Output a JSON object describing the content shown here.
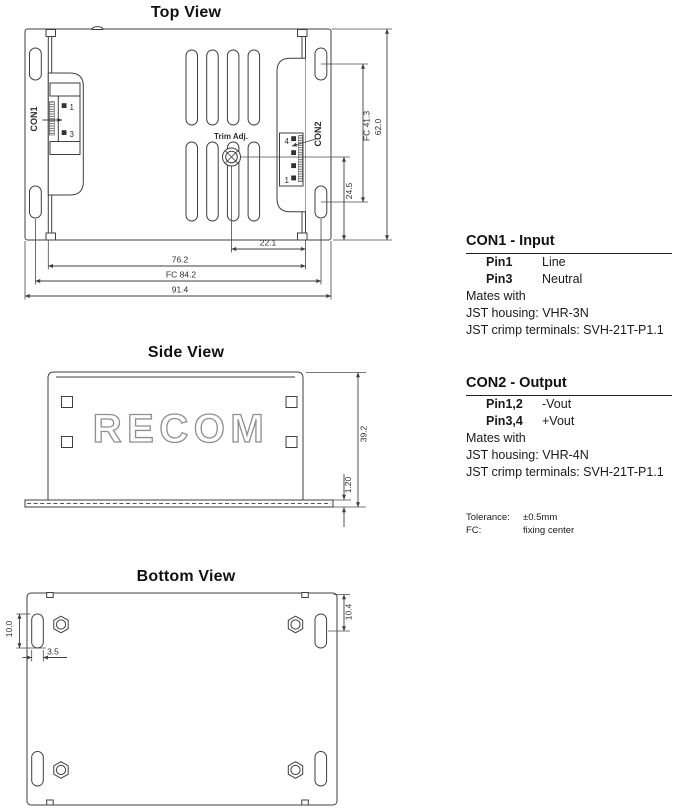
{
  "colors": {
    "line": "#3f3f3f",
    "dim_text": "#2e2e2e",
    "logo_outline": "#8f8f8f",
    "note_text": "#1a1a1a"
  },
  "views": {
    "top": {
      "title": "Top View",
      "con1_label": "CON1",
      "con2_label": "CON2",
      "trim_label": "Trim Adj.",
      "con1_pins": [
        "1",
        "3"
      ],
      "con2_pins": [
        "4",
        "1"
      ],
      "dims": {
        "trim_to_edge": "22.1",
        "body_width": "76.2",
        "fixing_center_h": "FC 84.2",
        "overall_width": "91.4",
        "trim_to_bottom": "24.5",
        "fixing_center_v": "FC 41.3",
        "overall_height": "62.0"
      }
    },
    "side": {
      "title": "Side View",
      "logo": "RECOM",
      "dims": {
        "height": "39.2",
        "baseplate": "1.20"
      }
    },
    "bottom": {
      "title": "Bottom View",
      "dims": {
        "slot_length": "10.0",
        "slot_width": "3.5",
        "slot_center_offset": "10.4"
      }
    }
  },
  "notes": {
    "con1": {
      "heading": "CON1 - Input",
      "rows": [
        {
          "pin": "Pin1",
          "signal": "Line"
        },
        {
          "pin": "Pin3",
          "signal": "Neutral"
        }
      ],
      "mates": "Mates with",
      "housing": "JST housing: VHR-3N",
      "crimp": "JST crimp terminals: SVH-21T-P1.1"
    },
    "con2": {
      "heading": "CON2 - Output",
      "rows": [
        {
          "pin": "Pin1,2",
          "signal": "-Vout"
        },
        {
          "pin": "Pin3,4",
          "signal": "+Vout"
        }
      ],
      "mates": "Mates with",
      "housing": "JST housing: VHR-4N",
      "crimp": "JST crimp terminals: SVH-21T-P1.1"
    },
    "footnotes": [
      {
        "label": "Tolerance:",
        "value": "±0.5mm"
      },
      {
        "label": "FC:",
        "value": "fixing center"
      }
    ]
  }
}
